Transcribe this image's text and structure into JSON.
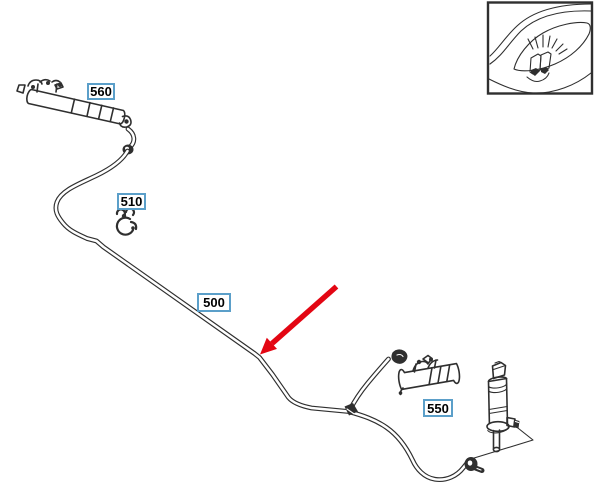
{
  "colors": {
    "background": "#ffffff",
    "line_color": "#2f2f2f",
    "callout_border": "#5b9fc9",
    "callout_text": "#000000",
    "arrow_color": "#e30613"
  },
  "callouts": {
    "c560": {
      "label": "560"
    },
    "c510": {
      "label": "510"
    },
    "c500": {
      "label": "500"
    },
    "c550": {
      "label": "550"
    }
  }
}
